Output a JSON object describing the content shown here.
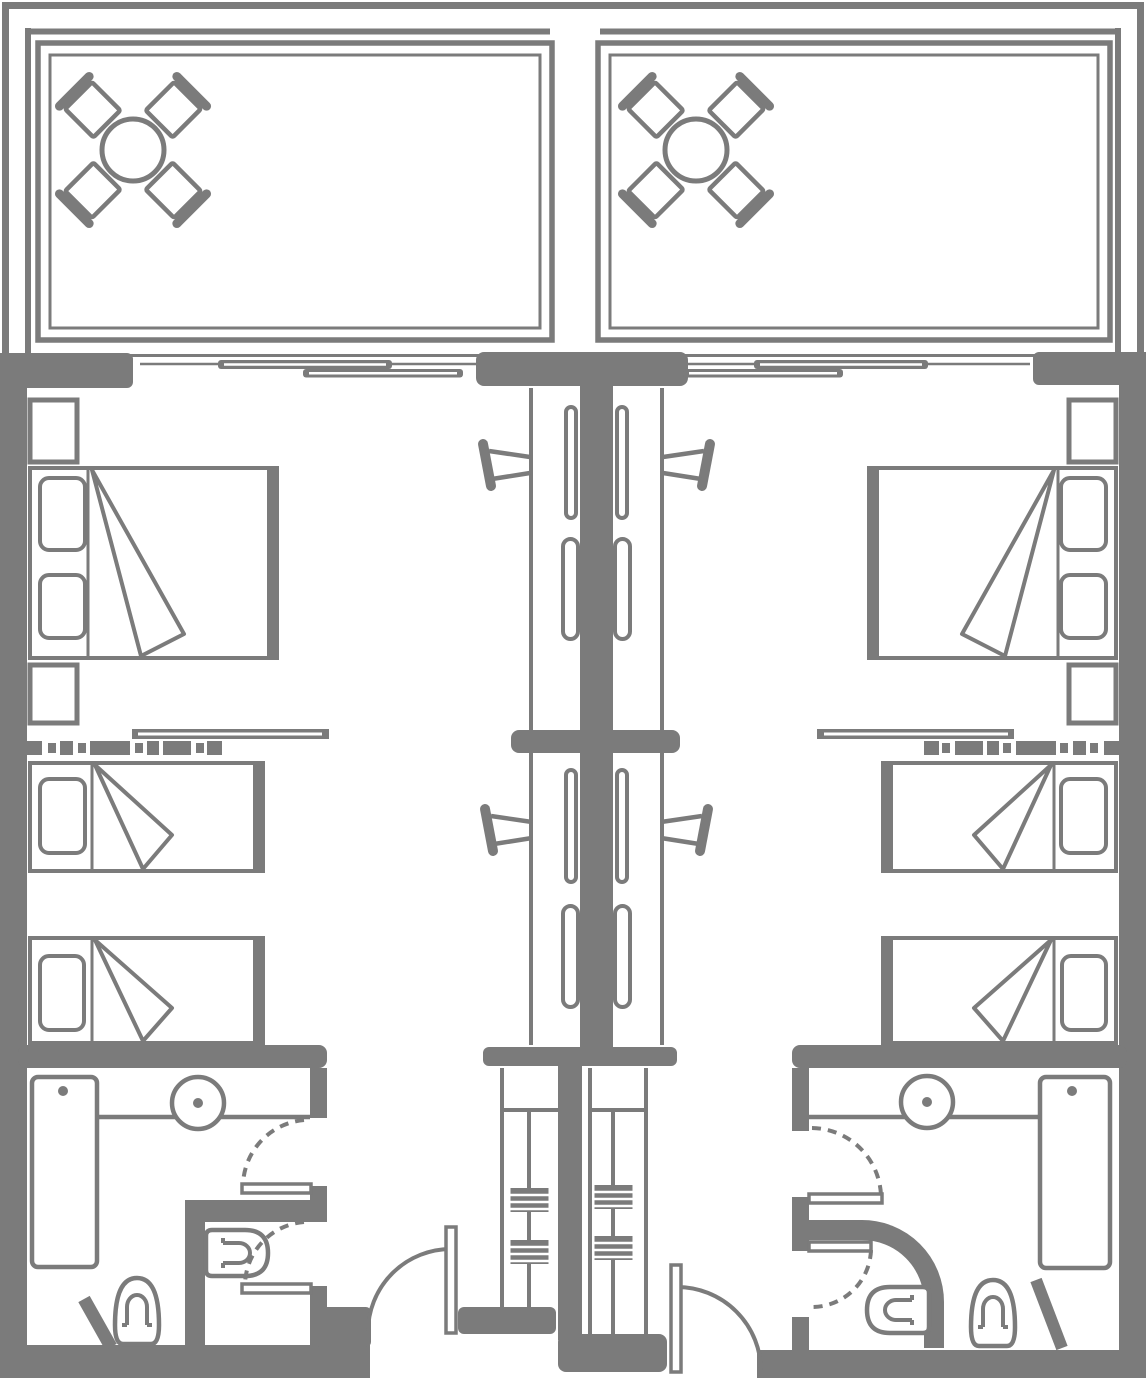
{
  "palette": {
    "line": "#7b7b7b",
    "background": "#ffffff"
  },
  "plan": {
    "kind": "floor-plan",
    "rooms": [
      "left guest room",
      "right guest room"
    ],
    "labels": {
      "floorplan": "Twin hotel guest room floor plan",
      "balcony_left": "Balcony (left room)",
      "balcony_right": "Balcony (right room)",
      "dining_set": "Round table with four chairs",
      "sliding_door_left": "Sliding glass balcony door (left room)",
      "sliding_door_right": "Sliding glass balcony door (right room)",
      "walls": "Walls",
      "envelope": "Building envelope outline",
      "bedside_left": "Left room furniture: beds, nightstands, TV console",
      "bedside_right": "Right room furniture: beds, nightstands, TV console",
      "double_bed": "Double bed",
      "single_bed": "Single bed",
      "nightstand": "Nightstand",
      "tv_console": "TV console",
      "desk_left": "Desk and wardrobe unit (left room)",
      "desk_right": "Desk and wardrobe unit (right room)",
      "desk_chair": "Desk chair",
      "closet_left": "Closet shelves (left)",
      "closet_right": "Closet shelves (right)",
      "bathroom_left": "Bathroom (left room)",
      "bathroom_right": "Bathroom (right room)",
      "shower": "Shower",
      "sink": "Washbasin",
      "toilet": "Toilet",
      "wc_toilet": "Wall-hung toilet in WC compartment",
      "bath_door": "Bathroom door",
      "wc_door": "WC compartment door",
      "entry_door_left": "Entry door (left room)",
      "entry_door_right": "Entry door (right room)"
    }
  }
}
